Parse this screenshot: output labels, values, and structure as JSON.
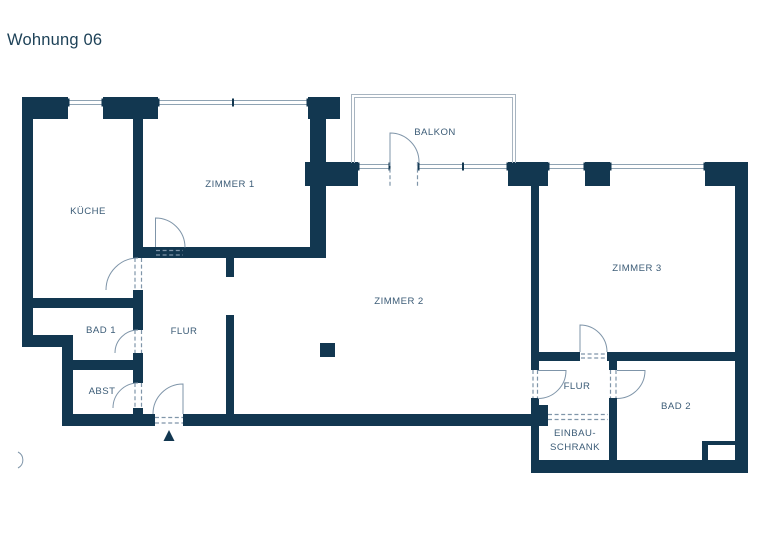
{
  "title": "Wohnung 06",
  "rooms": {
    "kueche": "KÜCHE",
    "zimmer1": "ZIMMER 1",
    "balkon": "BALKON",
    "zimmer2": "ZIMMER 2",
    "zimmer3": "ZIMMER 3",
    "bad1": "BAD 1",
    "flur": "FLUR",
    "abst": "ABST",
    "flur2": "FLUR",
    "bad2": "BAD 2",
    "einbauschrank_line1": "EINBAU-",
    "einbauschrank_line2": "SCHRANK"
  },
  "markers": {
    "entrance": "entrance-arrow"
  },
  "colors": {
    "wall": "#123750",
    "line": "#8fa3b3",
    "door_arc": "#7f95a9",
    "text": "#3c5c77",
    "title": "#1e4258",
    "railing": "#a7b4c0",
    "background": "#ffffff"
  }
}
